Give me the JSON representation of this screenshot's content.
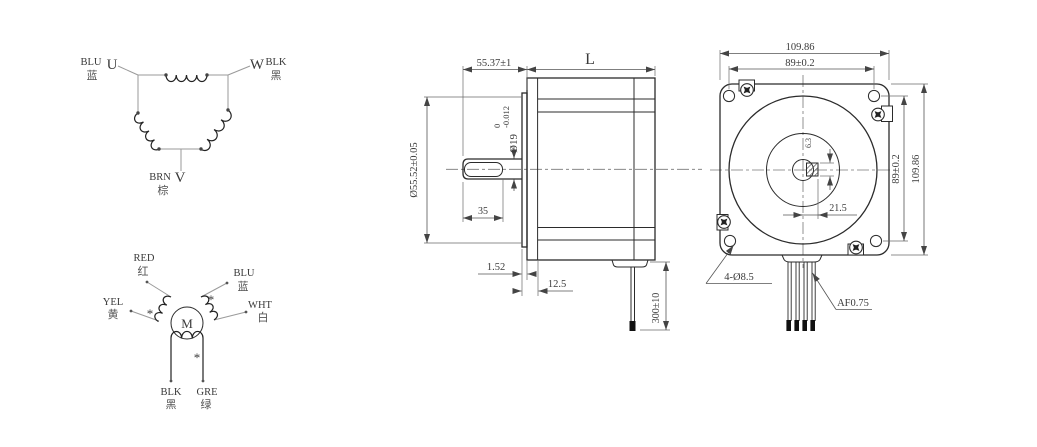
{
  "delta": {
    "u": {
      "phase": "U",
      "wire": "BLU",
      "cn": "蓝"
    },
    "w": {
      "phase": "W",
      "wire": "BLK",
      "cn": "黑"
    },
    "v": {
      "phase": "V",
      "wire": "BRN",
      "cn": "棕"
    }
  },
  "motor": {
    "label": "M",
    "mark": "*",
    "leads": {
      "red": {
        "en": "RED",
        "cn": "红"
      },
      "blu": {
        "en": "BLU",
        "cn": "蓝"
      },
      "yel": {
        "en": "YEL",
        "cn": "黄"
      },
      "wht": {
        "en": "WHT",
        "cn": "白"
      },
      "blk": {
        "en": "BLK",
        "cn": "黑"
      },
      "gre": {
        "en": "GRE",
        "cn": "绿"
      }
    }
  },
  "side_view": {
    "dims": {
      "shaft_length": "55.37±1",
      "body_length": "L",
      "shaft_diameter": "Ø19",
      "shaft_tol_upper": "0",
      "shaft_tol_lower": "-0.012",
      "pilot_diameter": "Ø55.52±0.05",
      "flat_length": "35",
      "plate_thickness": "1.52",
      "boss_depth": "12.5",
      "lead_length": "300±10"
    }
  },
  "front_view": {
    "dims": {
      "width": "109.86",
      "hole_spacing_h": "89±0.2",
      "hole_spacing_v": "89±0.2",
      "height": "109.86",
      "key_flat_offset": "21.5",
      "key_width": "6.3",
      "mounting_holes": "4-Ø8.5",
      "lead_spec": "AF0.75"
    }
  },
  "colors": {
    "line": "#2b2b2b",
    "dim": "#555555",
    "text": "#3a3a3a"
  }
}
